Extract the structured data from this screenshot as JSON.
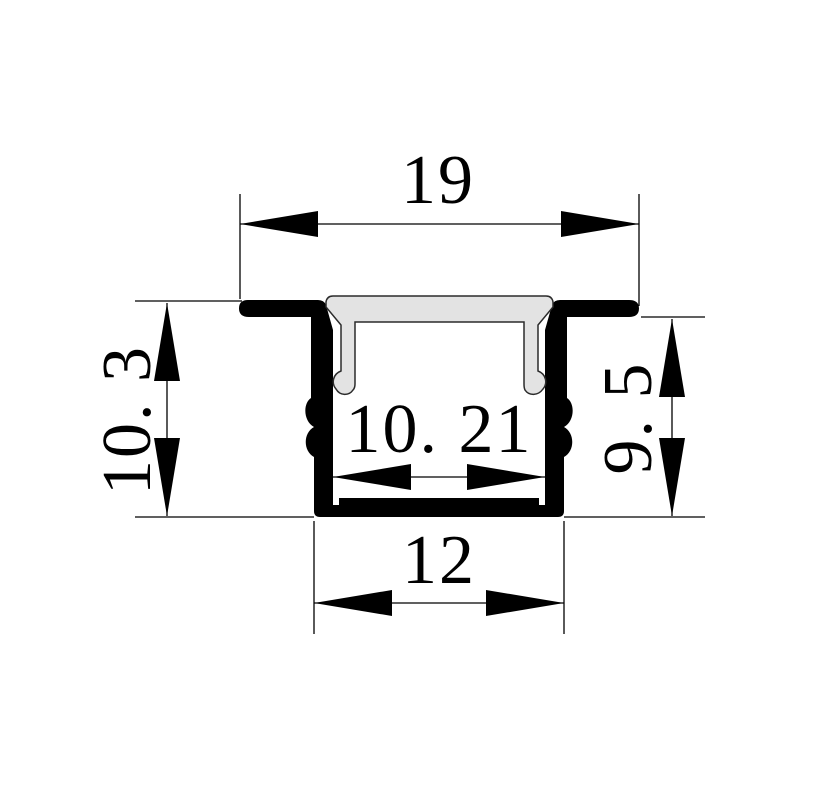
{
  "drawing": {
    "dimensions": {
      "top_width": "19",
      "inner_width": "10. 21",
      "left_height": "10. 3",
      "right_height": "9. 5",
      "bottom_width": "12"
    },
    "colors": {
      "background": "#ffffff",
      "line": "#000000",
      "aluminum_fill": "#000000",
      "diffuser_fill": "#e3e3e3",
      "diffuser_stroke": "#2b2b2b"
    }
  }
}
